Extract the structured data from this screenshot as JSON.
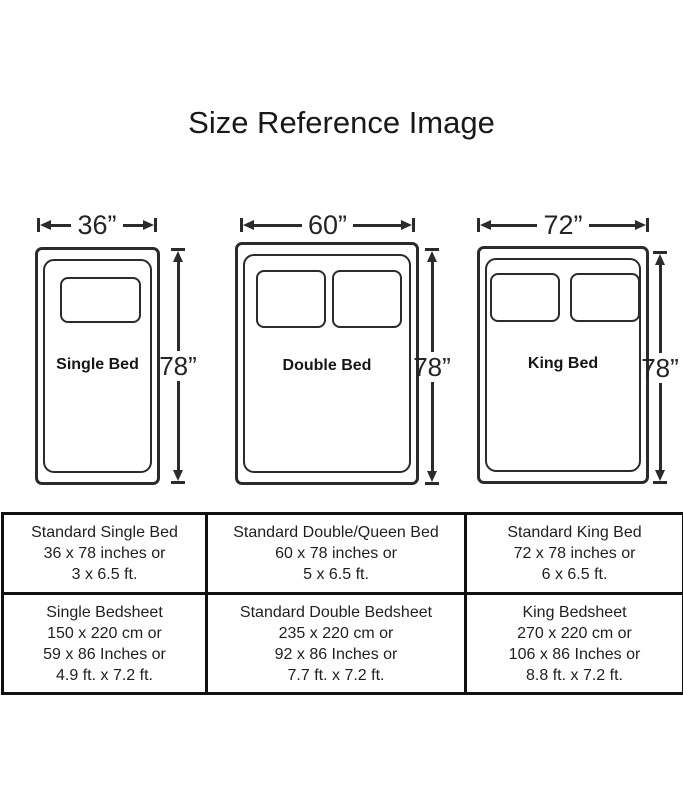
{
  "title": "Size Reference Image",
  "colors": {
    "line": "#2b2b2b",
    "table_border": "#101010",
    "background": "#ffffff"
  },
  "beds": [
    {
      "name": "Single Bed",
      "width": "36”",
      "height": "78”"
    },
    {
      "name": "Double Bed",
      "width": "60”",
      "height": "78”"
    },
    {
      "name": "King Bed",
      "width": "72”",
      "height": "78”"
    }
  ],
  "table": {
    "rows": [
      {
        "cells": [
          {
            "lines": [
              "Standard Single Bed",
              "36 x 78 inches or",
              "3 x 6.5 ft."
            ]
          },
          {
            "lines": [
              "Standard Double/Queen Bed",
              "60 x 78 inches or",
              "5 x 6.5 ft."
            ]
          },
          {
            "lines": [
              "Standard King Bed",
              "72 x 78 inches or",
              "6 x 6.5 ft."
            ]
          }
        ]
      },
      {
        "cells": [
          {
            "lines": [
              "Single Bedsheet",
              "150 x 220 cm or",
              "59 x 86 Inches or",
              "4.9 ft. x 7.2 ft."
            ]
          },
          {
            "lines": [
              "Standard Double Bedsheet",
              "235 x 220 cm or",
              "92 x 86 Inches or",
              "7.7 ft. x 7.2 ft."
            ]
          },
          {
            "lines": [
              "King Bedsheet",
              "270 x 220 cm or",
              "106 x 86 Inches or",
              "8.8 ft. x 7.2 ft."
            ]
          }
        ]
      }
    ]
  }
}
